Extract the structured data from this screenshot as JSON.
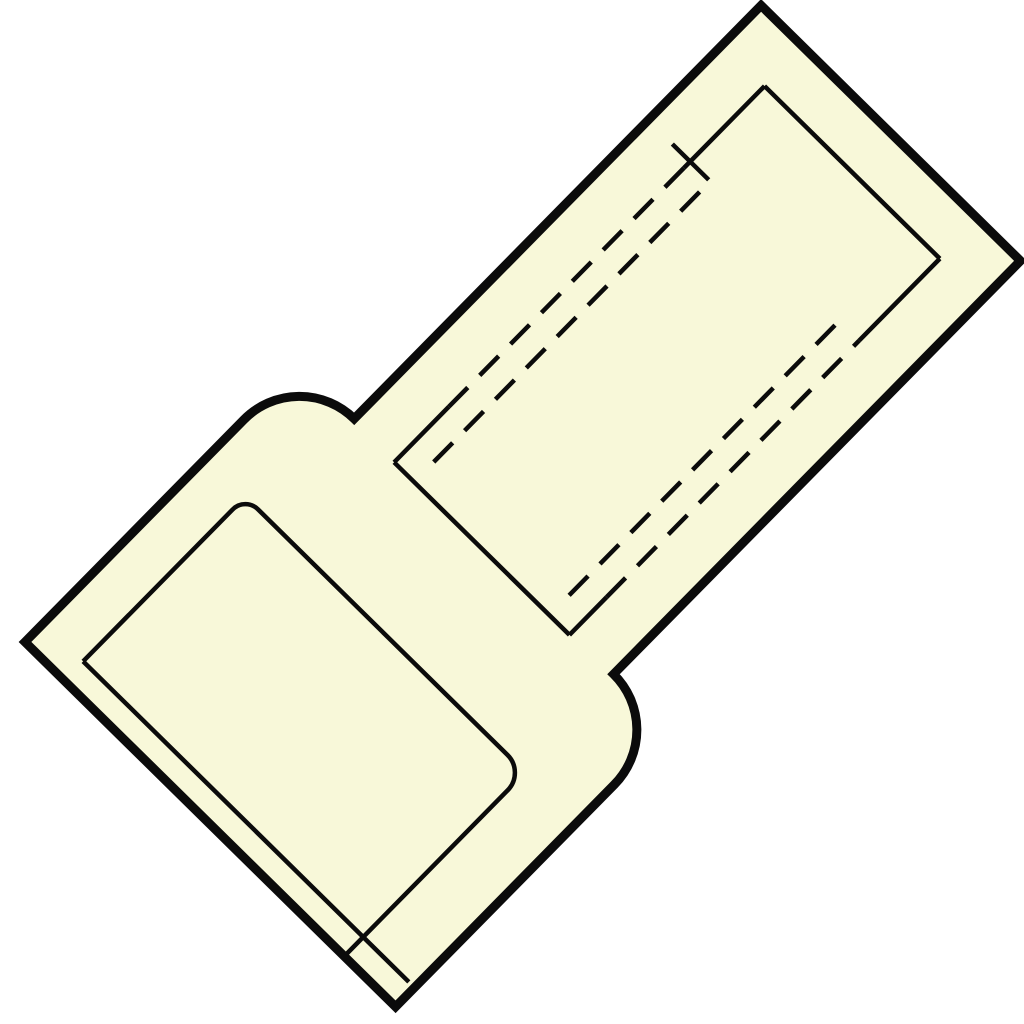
{
  "canvas": {
    "width": 1024,
    "height": 1024,
    "background": "#ffffff"
  },
  "drawing": {
    "kind": "technical-outline-drawing",
    "subject": "insulated-butt-splice-connector",
    "colors": {
      "body_fill": "#F8F8D9",
      "line": "#0B0B0B",
      "background": "#FFFFFF"
    },
    "orientation": {
      "translate_x": 25,
      "translate_y": 642,
      "rotate_deg": -45.45
    },
    "styles": {
      "outline_stroke_width": 9,
      "detail_stroke_width": 4.5,
      "dash_pattern": "27 17"
    },
    "paths": [
      {
        "name": "connector-body-outline",
        "kind": "outline",
        "d": "M 0 0 L 312 0 A 78 78 0 0 1 390 78 L 970 78 L 970 442 L 390 442 A 78 78 0 0 1 312 520 L 0 520 Z"
      },
      {
        "name": "entry-end-face-line",
        "kind": "solid",
        "d": "M 27 55 L 27 512"
      },
      {
        "name": "cavity-inner-wall-line",
        "kind": "solid",
        "d": "M 27 55 L 240 55 A 18 18 0 0 1 258 73 L 258 423 A 25 25 0 0 1 233 448 L 2 448"
      },
      {
        "name": "sleeve-left-end-line",
        "kind": "solid",
        "d": "M 387 137 L 387 383"
      },
      {
        "name": "sleeve-right-end-line",
        "kind": "solid",
        "d": "M 915 137 L 915 383"
      },
      {
        "name": "sleeve-top-edge-left-stub",
        "kind": "solid",
        "d": "M 387 137 L 465 137"
      },
      {
        "name": "sleeve-top-edge-right-stub",
        "kind": "solid",
        "d": "M 800 137 L 915 137"
      },
      {
        "name": "sleeve-bottom-edge-left-stub",
        "kind": "solid",
        "d": "M 387 383 L 440 383"
      },
      {
        "name": "sleeve-bottom-edge-right-stub",
        "kind": "solid",
        "d": "M 800 383 L 915 383"
      },
      {
        "name": "bore-end-tick",
        "kind": "solid",
        "d": "M 809 112 L 809 163"
      },
      {
        "name": "sleeve-top-edge-hidden",
        "kind": "dashed",
        "d": "M 465 137 L 800 137"
      },
      {
        "name": "sleeve-bottom-edge-hidden",
        "kind": "dashed",
        "d": "M 440 383 L 800 383"
      },
      {
        "name": "bore-top-hidden-line",
        "kind": "dashed",
        "d": "M 415 165 L 800 165"
      },
      {
        "name": "bore-bottom-hidden-line",
        "kind": "dashed",
        "d": "M 415 355 L 808 355"
      }
    ]
  }
}
